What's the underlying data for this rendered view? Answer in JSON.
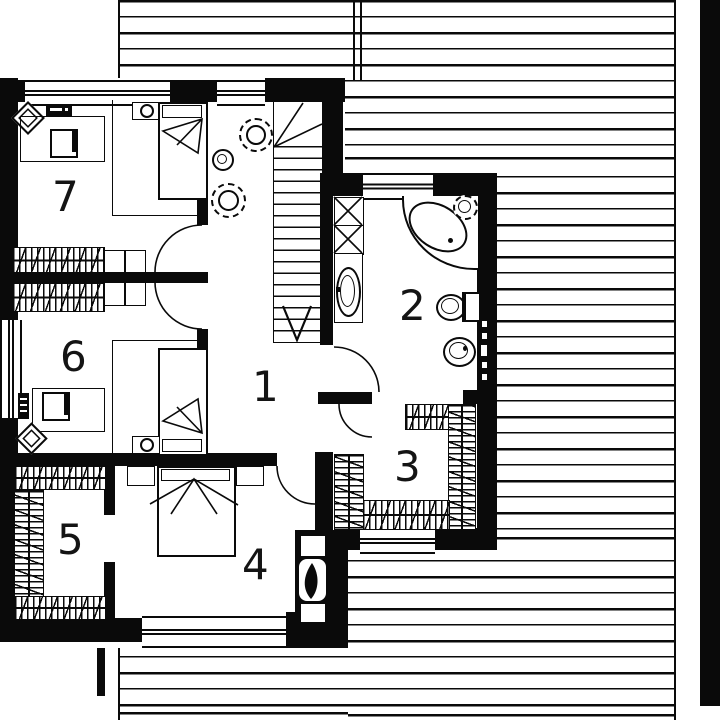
{
  "title": "upper floor plan",
  "colors": {
    "ink": "#0a0a0a",
    "paper": "#ffffff"
  },
  "room_labels": {
    "r1": "1",
    "r2": "2",
    "r3": "3",
    "r4": "4",
    "r5": "5",
    "r6": "6",
    "r7": "7"
  }
}
